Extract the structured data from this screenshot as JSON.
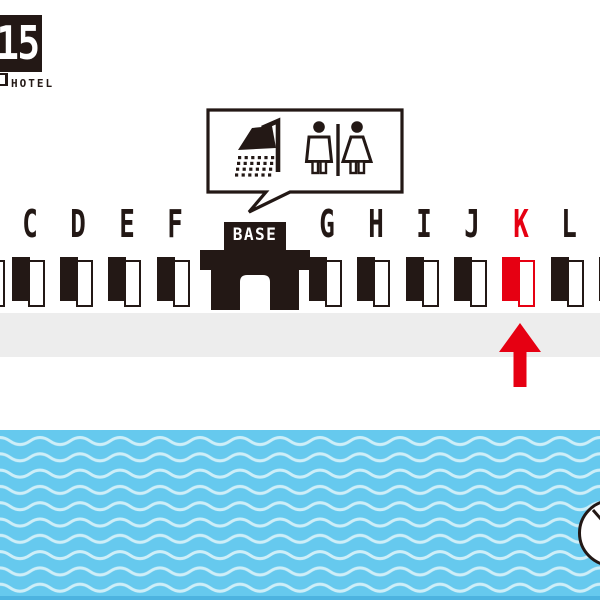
{
  "brand": {
    "logo_glyphs": "15",
    "caption": "HOTEL"
  },
  "callout": {
    "icons": [
      "shower",
      "mens-restroom",
      "womens-restroom"
    ]
  },
  "map": {
    "base_label": "BASE",
    "highlighted_room": "K",
    "rooms": [
      {
        "letter": "C",
        "x": 30,
        "highlight": false
      },
      {
        "letter": "D",
        "x": 78,
        "highlight": false
      },
      {
        "letter": "E",
        "x": 126.5,
        "highlight": false
      },
      {
        "letter": "F",
        "x": 175,
        "highlight": false
      },
      {
        "letter": "G",
        "x": 327,
        "highlight": false
      },
      {
        "letter": "H",
        "x": 375.5,
        "highlight": false
      },
      {
        "letter": "I",
        "x": 424,
        "highlight": false
      },
      {
        "letter": "J",
        "x": 472,
        "highlight": false
      },
      {
        "letter": "K",
        "x": 520.5,
        "highlight": true
      },
      {
        "letter": "L",
        "x": 569,
        "highlight": false
      }
    ],
    "partial_room_left_x": 6,
    "partial_room_right_x": 598.5
  },
  "colors": {
    "ink": "#231815",
    "highlight": "#e60012",
    "walkway": "#ededed",
    "sea": "#66c9ee",
    "wave": "#cdeef8",
    "sea_edge": "#4db3e0"
  }
}
